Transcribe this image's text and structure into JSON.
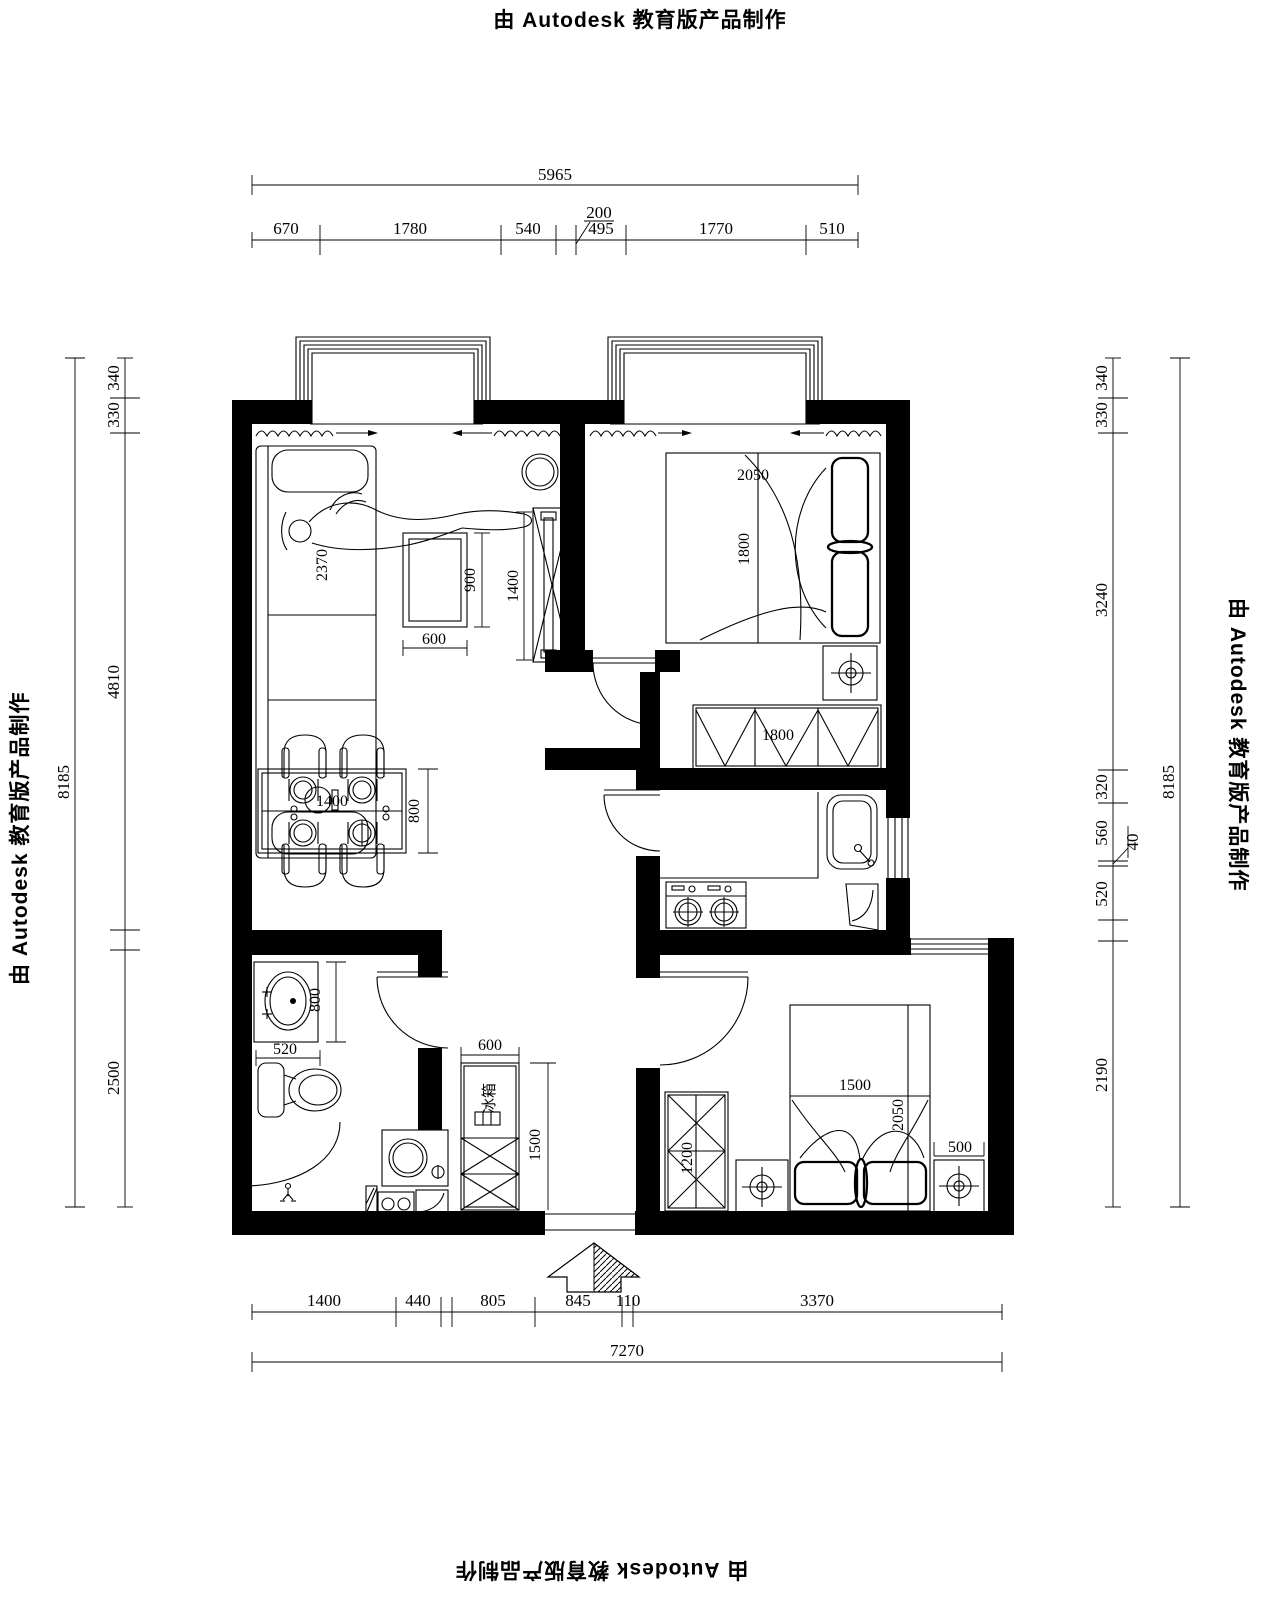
{
  "watermark": {
    "text": "由 Autodesk 教育版产品制作"
  },
  "dims": {
    "top": {
      "total": "5965",
      "segments": [
        "670",
        "1780",
        "540",
        "495",
        "1770",
        "510"
      ],
      "leader": "200"
    },
    "bottom": {
      "total": "7270",
      "segments": [
        "1400",
        "440",
        "805",
        "845",
        "110",
        "3370"
      ]
    },
    "left": {
      "total": "8185",
      "segments": [
        "340",
        "330",
        "4810",
        "2500"
      ]
    },
    "right": {
      "total": "8185",
      "segments": [
        "340",
        "330",
        "3240",
        "320",
        "560",
        "520",
        "2190"
      ],
      "leader": "40"
    }
  },
  "furniture_dims": {
    "sofa_length": "2370",
    "coffee_table_width": "600",
    "coffee_table_depth": "900",
    "tv_cabinet_length": "1400",
    "dining_table_length": "1400",
    "dining_table_depth": "800",
    "bed1_width": "2050",
    "bed1_length": "1800",
    "wardrobe1_length": "1800",
    "basin_counter_width": "520",
    "basin_counter_depth": "800",
    "fridge_width": "600",
    "fridge_cabinet_height": "1500",
    "fridge_label": "冰箱",
    "wardrobe2_length": "1200",
    "bed2_width": "1500",
    "bed2_length": "2050",
    "nightstand_width": "500"
  }
}
